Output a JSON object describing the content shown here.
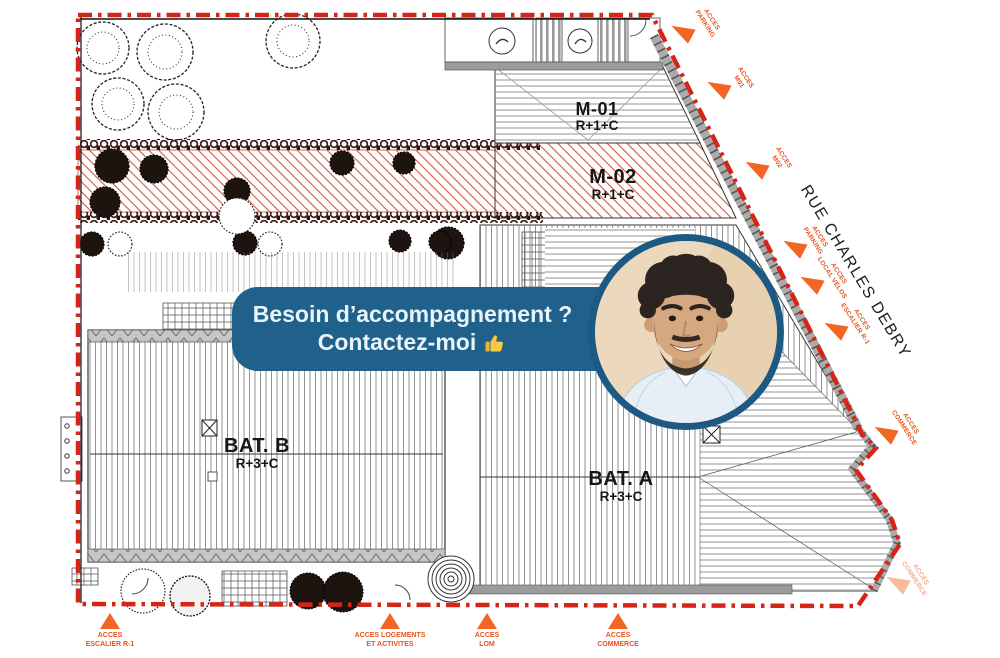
{
  "banner": {
    "line1": "Besoin d’accompagnement ?",
    "line2": "Contactez-moi",
    "thumb_icon": "👍"
  },
  "plan": {
    "street_name": "RUE CHARLES DEBRY",
    "buildings": [
      {
        "name": "M-01",
        "floors": "R+1+C"
      },
      {
        "name": "M-02",
        "floors": "R+1+C"
      },
      {
        "name": "BAT. B",
        "floors": "R+3+C"
      },
      {
        "name": "BAT. A",
        "floors": "R+3+C"
      }
    ],
    "access_side": [
      {
        "label": "ACCES\nPARKING"
      },
      {
        "label": "ACCES\nM01"
      },
      {
        "label": "ACCES\nM02"
      },
      {
        "label": "ACCES\nPARKING"
      },
      {
        "label": "ACCES\nLOCAL VELOS"
      },
      {
        "label": "ACCES\nESCALIER R-1"
      },
      {
        "label": "ACCES\nCOMMERCE"
      },
      {
        "label": "ACCES\nCOMMERCE"
      }
    ],
    "access_bottom": [
      {
        "label": "ACCES\nESCALIER R-1"
      },
      {
        "label": "ACCES LOGEMENTS\nET ACTIVITES"
      },
      {
        "label": "ACCES\nLOM"
      },
      {
        "label": "ACCES\nCOMMERCE"
      }
    ]
  },
  "colors": {
    "boundary_red": "#d62517",
    "arrow_orange": "#f26522",
    "access_label_orange": "#e8541d",
    "banner_blue": "#20618b",
    "photo_border_blue": "#1c5a83",
    "hatch_red": "#cc5a41"
  }
}
